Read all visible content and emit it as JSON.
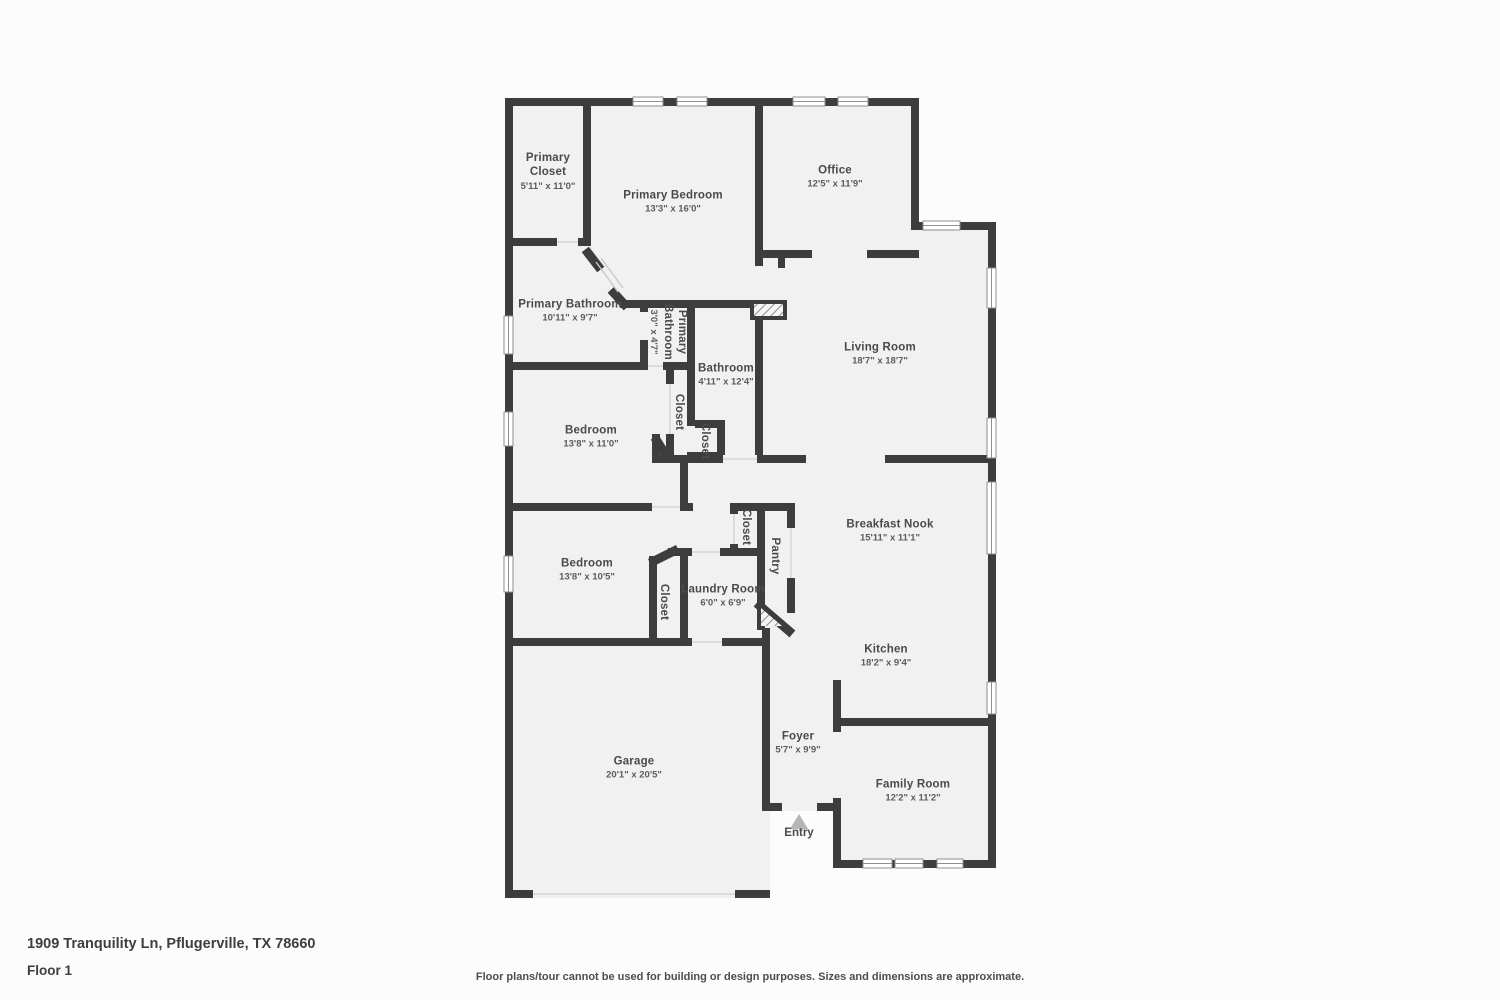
{
  "page": {
    "background": "#fcfcfc",
    "wall_color": "#3d3d3d",
    "floor_color": "#f1f1f1",
    "entry_arrow_color": "#b5b5b5"
  },
  "rooms": [
    {
      "id": "primary-closet",
      "name": "Primary Closet",
      "dims": "5'11\" x 11'0\"",
      "orientation": "horizontal"
    },
    {
      "id": "primary-bedroom",
      "name": "Primary Bedroom",
      "dims": "13'3\" x 16'0\"",
      "orientation": "horizontal"
    },
    {
      "id": "office",
      "name": "Office",
      "dims": "12'5\" x 11'9\"",
      "orientation": "horizontal"
    },
    {
      "id": "primary-bathroom",
      "name": "Primary Bathroom",
      "dims": "10'11\" x 9'7\"",
      "orientation": "horizontal"
    },
    {
      "id": "primary-bathroom-small",
      "name": "Primary Bathroom",
      "dims": "3'0\" x 4'7\"",
      "orientation": "vertical"
    },
    {
      "id": "bathroom",
      "name": "Bathroom",
      "dims": "4'11\" x 12'4\"",
      "orientation": "horizontal"
    },
    {
      "id": "living-room",
      "name": "Living Room",
      "dims": "18'7\" x 18'7\"",
      "orientation": "horizontal"
    },
    {
      "id": "bedroom-1",
      "name": "Bedroom",
      "dims": "13'8\" x 11'0\"",
      "orientation": "horizontal"
    },
    {
      "id": "hall-closet-1",
      "name": "Closet",
      "dims": "",
      "orientation": "vertical"
    },
    {
      "id": "hall-closet-2",
      "name": "Closet",
      "dims": "",
      "orientation": "vertical"
    },
    {
      "id": "breakfast-nook",
      "name": "Breakfast Nook",
      "dims": "15'11\" x 11'1\"",
      "orientation": "horizontal"
    },
    {
      "id": "laundry-closet",
      "name": "Closet",
      "dims": "",
      "orientation": "vertical"
    },
    {
      "id": "pantry",
      "name": "Pantry",
      "dims": "",
      "orientation": "vertical"
    },
    {
      "id": "bedroom-2",
      "name": "Bedroom",
      "dims": "13'8\" x 10'5\"",
      "orientation": "horizontal"
    },
    {
      "id": "bedroom-2-closet",
      "name": "Closet",
      "dims": "",
      "orientation": "vertical"
    },
    {
      "id": "laundry-room",
      "name": "Laundry Room",
      "dims": "6'0\" x 6'9\"",
      "orientation": "horizontal"
    },
    {
      "id": "kitchen",
      "name": "Kitchen",
      "dims": "18'2\" x 9'4\"",
      "orientation": "horizontal"
    },
    {
      "id": "garage",
      "name": "Garage",
      "dims": "20'1\" x 20'5\"",
      "orientation": "horizontal"
    },
    {
      "id": "foyer",
      "name": "Foyer",
      "dims": "5'7\" x 9'9\"",
      "orientation": "horizontal"
    },
    {
      "id": "family-room",
      "name": "Family Room",
      "dims": "12'2\" x 11'2\"",
      "orientation": "horizontal"
    }
  ],
  "entry": {
    "label": "Entry"
  },
  "footer": {
    "address": "1909 Tranquility Ln, Pflugerville, TX 78660",
    "floor_label": "Floor 1",
    "disclaimer": "Floor plans/tour cannot be used for building or design purposes. Sizes and dimensions are approximate."
  }
}
